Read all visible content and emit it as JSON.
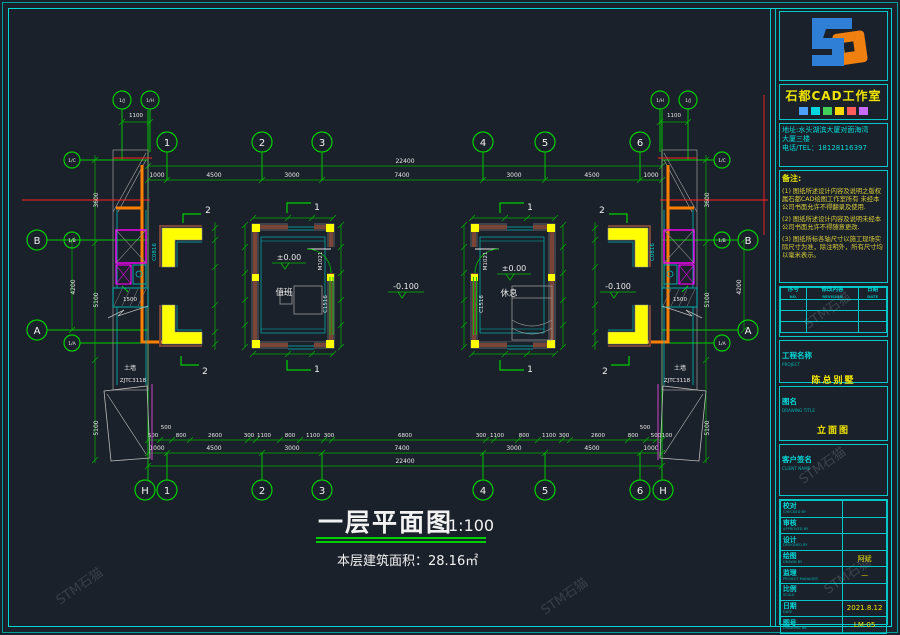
{
  "plan": {
    "title": "一层平面图",
    "scale": "1:100",
    "area_note": "本层建筑面积：28.16㎡",
    "grid_top": [
      "1",
      "2",
      "3",
      "4",
      "5",
      "6"
    ],
    "grid_bottom": [
      "H",
      "1",
      "2",
      "3",
      "4",
      "5",
      "6",
      "H"
    ],
    "grid_left": [
      "B",
      "A"
    ],
    "grid_right": [
      "B",
      "A"
    ],
    "aux_top_left": [
      "1/J",
      "1/H"
    ],
    "aux_top_right": [
      "1/H",
      "1/J"
    ],
    "aux_left": [
      "1/C",
      "1/B",
      "1/A"
    ],
    "aux_right": [
      "1/C",
      "1/B",
      "1/A"
    ],
    "dim_total": "22400",
    "dims_main": [
      "1000",
      "4500",
      "3000",
      "7400",
      "3000",
      "4500",
      "1000"
    ],
    "dims_detail": [
      "500",
      "500",
      "800",
      "2600",
      "300",
      "1100",
      "800",
      "1100",
      "300",
      "6800",
      "300",
      "1100",
      "800",
      "1100",
      "300",
      "2600",
      "800",
      "500",
      "500",
      "100"
    ],
    "dims_left": [
      "3600",
      "5100",
      "5100",
      "4200"
    ],
    "dims_right": [
      "3600",
      "5100",
      "5100",
      "4200"
    ],
    "dim_aux": "1100",
    "levels": {
      "zero": "±0.00",
      "minus": "-0.100"
    },
    "rooms": [
      {
        "name": "值班",
        "door": "M1021",
        "window": "C1516"
      },
      {
        "name": "休息",
        "door": "M1021",
        "window": "C1516"
      }
    ],
    "side_labels": {
      "window_code": "C0816",
      "band": "1500",
      "wall": "土墙",
      "frame": "ZJTC3118"
    },
    "sections": {
      "room": "1",
      "detail": "2"
    }
  },
  "titleblock": {
    "company": "石都CAD工作室",
    "brand_squares": [
      "#4a9fff",
      "#00d5e0",
      "#42d05a",
      "#ffd900",
      "#ff5c5c",
      "#c86bff"
    ],
    "address_line1": "地址:水头湖滨大厦对面海湾",
    "address_line2": "大厦三楼",
    "address_line3": "电话/TEL：18128116397",
    "notes_title": "备注:",
    "notes": [
      "(1) 图纸所述设计内容及说明之版权属石都CAD绘图工作室所有 未经本公司书面允许不得翻录及使用.",
      "(2) 图纸所述设计内容及说明未经本公司书面允许不得随意更改.",
      "(3) 图纸所标各轴尺寸以施工现场实际尺寸为准，除注明外，所有尺寸均以毫米表示。"
    ],
    "rev_headers": [
      {
        "zh": "序号",
        "en": "NO."
      },
      {
        "zh": "修改内容",
        "en": "REVISION"
      },
      {
        "zh": "日期",
        "en": "DATE"
      }
    ],
    "project_label": {
      "zh": "工程名称",
      "en": "PROJECT"
    },
    "project_name": "陈总别墅",
    "title_label": {
      "zh": "图名",
      "en": "DRAWING TITLE"
    },
    "drawing_title": "立面图",
    "client_label": {
      "zh": "客户签名",
      "en": "CLIENT NAME"
    },
    "fields": [
      {
        "zh": "校对",
        "en": "CHECKED BY",
        "value": ""
      },
      {
        "zh": "审核",
        "en": "APPROVED BY",
        "value": ""
      },
      {
        "zh": "设计",
        "en": "DESIGNED BY",
        "value": ""
      },
      {
        "zh": "绘图",
        "en": "DRAWN BY",
        "value": "阿斌"
      },
      {
        "zh": "监理",
        "en": "PROJECT MANAGER",
        "value": "—"
      },
      {
        "zh": "比例",
        "en": "SCALE",
        "value": ""
      },
      {
        "zh": "日期",
        "en": "DATE",
        "value": "2021.8.12"
      },
      {
        "zh": "图号",
        "en": "DRAWING No.",
        "value": "LM-05"
      }
    ]
  },
  "watermark": "STM石猫"
}
